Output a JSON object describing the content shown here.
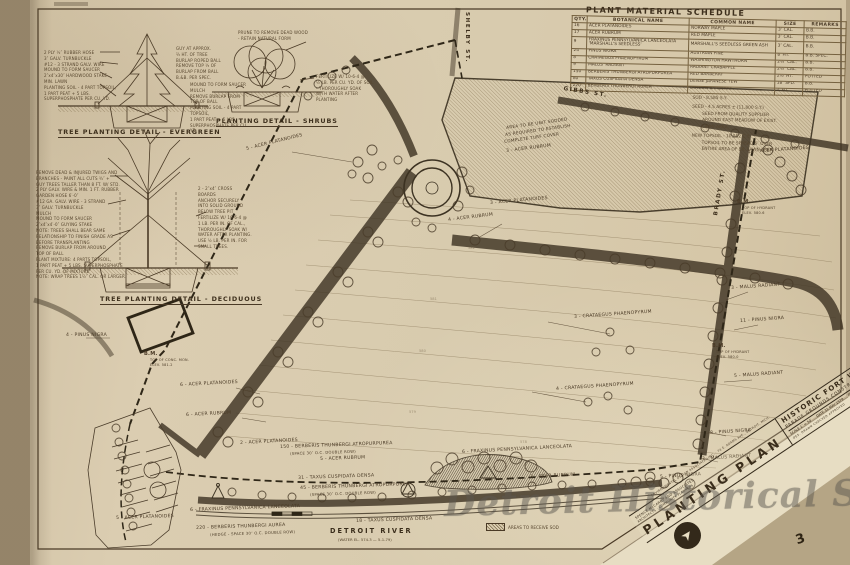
{
  "schedule": {
    "title": "PLANT MATERIAL SCHEDULE",
    "columns": [
      "QTY.",
      "BOTANICAL NAME",
      "COMMON NAME",
      "SIZE",
      "REMARKS"
    ],
    "rows": [
      [
        "16",
        "ACER PLATANOIDES",
        "NORWAY MAPLE",
        "3″ CAL.",
        "B.B."
      ],
      [
        "17",
        "ACER RUBRUM",
        "RED MAPLE",
        "3″ CAL.",
        "B.B."
      ],
      [
        "9",
        "FRAXINUS PENNSYLVANICA LANCEOLATA 'MARSHALL'S SEEDLESS'",
        "MARSHALL'S SEEDLESS GREEN ASH",
        "3″ CAL.",
        "B.B."
      ],
      [
        "24",
        "PINUS NIGRA",
        "AUSTRIAN PINE",
        "8′ HT.",
        "B.B. SPEC."
      ],
      [
        "8",
        "CRATAEGUS PHAENOPYRUM",
        "WASHINGTON HAWTHORN",
        "2½″ CAL.",
        "B.B."
      ],
      [
        "9",
        "MALUS 'RADIANT'",
        "RADIANT CRABAPPLE",
        "2½″ CAL.",
        "B.B."
      ],
      [
        "150",
        "BERBERIS THUNBERGI ATROPURPUREA",
        "RED BARBERRY",
        "2½′ HT.",
        "POTTED"
      ],
      [
        "80",
        "TAXUS CUSPIDATA DENSA",
        "DENSE JAPANESE YEW",
        "18″ SPD.",
        "B.B."
      ],
      [
        "220",
        "BERBERIS THUNBERGI AUREA",
        "GOLDEN BARBERRY",
        "2′ HT.",
        "POTTED"
      ]
    ]
  },
  "site_notes": [
    {
      "text": "SOD - 8,585 S.Y."
    },
    {
      "text": "SEED - 4.5 ACRES ± (11,800 S.Y.)",
      "gap": true
    },
    {
      "text": "SEED FROM QUALITY SUPPLIER",
      "indent": true
    },
    {
      "text": "AROUND EAST MEADOW OF EXIST.",
      "indent": true
    },
    {
      "text": "LAWN AREA.",
      "indent": true
    },
    {
      "text": "NEW TOPSOIL - 10,552 C.Y.",
      "gap": true
    },
    {
      "text": "TOPSOIL TO BE SPREAD 6″ OVER",
      "indent": true
    },
    {
      "text": "ENTIRE AREA OF EX. LAWN AREA.",
      "indent": true
    }
  ],
  "details": {
    "evergreen": {
      "title": "TREE PLANTING DETAIL - EVERGREEN",
      "left": [
        "2 PLY ½″ RUBBER HOSE",
        "3″ GALV. TURNBUCKLE",
        "#12 - 3 STRAND GALV. WIRE",
        "MOUND TO FORM SAUCER",
        "2″x4″x30″ HARDWOOD STAKE",
        "MIN. LAWN",
        "PLANTING SOIL - 4 PART TOPSOIL,",
        "1 PART PEAT + 5 LBS.",
        "SUPERPHOSPHATE PER CU. YD."
      ],
      "right": [
        "GUY AT APPROX.",
        "⅔ HT. OF TREE",
        "BURLAP ROPED BALL",
        "REMOVE TOP ⅓ OF",
        "BURLAP FROM BALL",
        "B.&B. PER SPEC."
      ]
    },
    "shrubs": {
      "title": "PLANTING DETAIL - SHRUBS",
      "top": [
        "PRUNE TO REMOVE DEAD WOOD",
        "- RETAIN NATURAL FORM"
      ],
      "left": [
        "MOUND TO FORM SAUCER",
        "MULCH",
        "REMOVE BURLAP FROM",
        "TOP OF BALL",
        "PLANTING SOIL - 4 PART TOPSOIL,",
        "1 PART PEAT + 5 LBS.",
        "SUPERPHOSPHATE PER CU. YD."
      ],
      "right": [
        "FERTILIZE W/ 10-6-4 @",
        "½ LB. PER CU. YD. OF SOIL",
        "- THOROUGHLY SOAK",
        "WITH WATER AFTER",
        "PLANTING"
      ]
    },
    "deciduous": {
      "title": "TREE PLANTING DETAIL - DECIDUOUS",
      "left": [
        "REMOVE DEAD & INJURED TWIGS AND",
        "BRANCHES - PAINT ALL CUTS ¾″ +",
        "GUY TREES TALLER THAN 8 FT. W/ STD.",
        "2 PLY GALV. WIRE & MIN. 1 FT. RUBBER",
        "GARDEN HOSE 6′-0″",
        "#12 GA. GALV. WIRE - 3 STRAND",
        "3″ GALV. TURNBUCKLE",
        "MULCH",
        "MOUND TO FORM SAUCER",
        "2″x4″x4′-0″ GUYING STAKE",
        "NOTE: TREES SHALL BEAR SAME",
        "RELATIONSHIP TO FINISH GRADE AS",
        "BEFORE TRANSPLANTING",
        "REMOVE BURLAP FROM AROUND",
        "TOP OF BALL",
        "PLANT MIXTURE: 4 PARTS TOPSOIL,",
        "1 PART PEAT + 5 LBS. SUPERPHOSPHATE",
        "PER CU. YD. OF MIXTURE",
        "NOTE: WRAP TREES 1½″ CAL. OR LARGER."
      ],
      "right": [
        "2 - 2″x4″ CROSS",
        "BOARDS",
        "ANCHOR SECURELY",
        "INTO SOLID GROUND",
        "BELOW TREE PIT",
        "FERTILIZE W/ 10-6-4 @",
        "1 LB. PER IN. OF CAL.,",
        "THOROUGHLY SOAK W/",
        "WATER AFTER PLANTING.",
        "USE ½ LB. PER IN. FOR",
        "SMALL TREES."
      ]
    }
  },
  "plan": {
    "streets": [
      {
        "text": "SHELBY ST.",
        "x": 470,
        "y": 12,
        "rot": 90
      },
      {
        "text": "GIBBS ST.",
        "x": 564,
        "y": 86,
        "rot": 9
      },
      {
        "text": "BRADY ST.",
        "x": 713,
        "y": 215,
        "rot": -80
      }
    ],
    "labels": [
      {
        "text": "5 - ACER PLATANOIDES",
        "x": 246,
        "y": 148,
        "rot": -14
      },
      {
        "text": "3 - ACER RUBRUM",
        "x": 506,
        "y": 150,
        "rot": -7
      },
      {
        "text": "3 - ACER PLATANOIDES",
        "x": 490,
        "y": 202,
        "rot": -5
      },
      {
        "text": "4 - ACER RUBRUM",
        "x": 448,
        "y": 219,
        "rot": -7
      },
      {
        "text": "12 - ACER PLATANOIDES",
        "x": 748,
        "y": 151,
        "rot": -4
      },
      {
        "text": "3 - CRATAEGUS PHAENOPYRUM",
        "x": 574,
        "y": 316,
        "rot": -4
      },
      {
        "text": "4 - CRATAEGUS PHAENOPYRUM",
        "x": 556,
        "y": 388,
        "rot": -4
      },
      {
        "text": "3 - MALUS RADIANT",
        "x": 731,
        "y": 287,
        "rot": -4
      },
      {
        "text": "11 - PINUS NIGRA",
        "x": 740,
        "y": 320,
        "rot": -4
      },
      {
        "text": "5 - MALUS RADIANT",
        "x": 734,
        "y": 375,
        "rot": -4
      },
      {
        "text": "8 - PINUS NIGRA",
        "x": 710,
        "y": 432,
        "rot": -4
      },
      {
        "text": "3 - MALUS RADIANT",
        "x": 702,
        "y": 458,
        "rot": -4
      },
      {
        "text": "5 - PINUS NIGRA",
        "x": 660,
        "y": 476,
        "rot": -4
      },
      {
        "text": "4 - PINUS NIGRA",
        "x": 66,
        "y": 334
      },
      {
        "text": "6 - ACER PLATANOIDES",
        "x": 180,
        "y": 384,
        "rot": -3
      },
      {
        "text": "6 - ACER RUBRUM",
        "x": 186,
        "y": 414,
        "rot": -3
      },
      {
        "text": "2 - ACER PLATANOIDES",
        "x": 240,
        "y": 442,
        "rot": -3
      },
      {
        "text": "150 - BERBERIS THUNBERGI ATROPURPUREA",
        "x": 280,
        "y": 446,
        "rot": -2
      },
      {
        "text": "(SPACE 30″ O.C. DOUBLE ROW)",
        "x": 290,
        "y": 452,
        "rot": -2,
        "size": 3.8
      },
      {
        "text": "5 - ACER RUBRUM",
        "x": 320,
        "y": 458,
        "rot": -2
      },
      {
        "text": "31 - TAXUS CUSPIDATA DENSA",
        "x": 298,
        "y": 477,
        "rot": -2
      },
      {
        "text": "45 - BERBERIS THUNBERGI ATROPURPUREA",
        "x": 300,
        "y": 487,
        "rot": -2
      },
      {
        "text": "(SPACE 30″ O.C. DOUBLE ROW)",
        "x": 310,
        "y": 493,
        "rot": -2,
        "size": 3.8
      },
      {
        "text": "2 - ACER RUBRUM",
        "x": 530,
        "y": 476,
        "rot": -3
      },
      {
        "text": "6 - FRAXINUS PENNSYLVANICA LANCEOLATA",
        "x": 462,
        "y": 451,
        "rot": -3
      },
      {
        "text": "18 - TAXUS CUSPIDATA DENSA",
        "x": 356,
        "y": 520,
        "rot": -2
      },
      {
        "text": "5 - ACER PLATANOIDES",
        "x": 116,
        "y": 517,
        "rot": -2
      },
      {
        "text": "6 - FRAXINUS PENNSYLVANICA LANCEOLATA",
        "x": 190,
        "y": 509,
        "rot": -2
      },
      {
        "text": "220 - BERBERIS THUNBERGI AUREA",
        "x": 196,
        "y": 527,
        "rot": -2
      },
      {
        "text": "(HEDGE - SPACE 30″ O.C. DOUBLE ROW)",
        "x": 210,
        "y": 533,
        "rot": -2,
        "size": 3.8
      },
      {
        "text": "AREA TO BE UNIT SODDED",
        "x": 506,
        "y": 126,
        "rot": -8,
        "size": 4.2
      },
      {
        "text": "AS REQUIRED TO ESTABLISH",
        "x": 505,
        "y": 133,
        "rot": -8,
        "size": 4.2
      },
      {
        "text": "COMPLETE TURF COVER",
        "x": 504,
        "y": 140,
        "rot": -8,
        "size": 4.2
      },
      {
        "text": "B.M.",
        "x": 144,
        "y": 352,
        "size": 5,
        "bold": true,
        "name": "benchmark-label"
      },
      {
        "text": "TOP OF CONC. MON.",
        "x": 150,
        "y": 359,
        "size": 3.4
      },
      {
        "text": "ELEV. 581.2",
        "x": 150,
        "y": 364,
        "size": 3.4
      },
      {
        "text": "B.M.",
        "x": 737,
        "y": 200,
        "size": 5,
        "bold": true,
        "name": "benchmark-label"
      },
      {
        "text": "TOP OF HYDRANT",
        "x": 742,
        "y": 207,
        "size": 3.4
      },
      {
        "text": "ELEV. 580.6",
        "x": 742,
        "y": 212,
        "size": 3.4
      },
      {
        "text": "B.M.",
        "x": 712,
        "y": 344,
        "size": 5,
        "bold": true,
        "name": "benchmark-label"
      },
      {
        "text": "TOP OF HYDRANT",
        "x": 716,
        "y": 351,
        "size": 3.4
      },
      {
        "text": "ELEV. 580.0",
        "x": 716,
        "y": 356,
        "size": 3.4
      }
    ],
    "contour_labels": [
      {
        "text": "582",
        "x": 468,
        "y": 246
      },
      {
        "text": "581",
        "x": 430,
        "y": 297
      },
      {
        "text": "580",
        "x": 419,
        "y": 349
      },
      {
        "text": "579",
        "x": 409,
        "y": 410
      },
      {
        "text": "578",
        "x": 520,
        "y": 440
      }
    ],
    "river": {
      "name": "DETROIT RIVER",
      "note": "(WATER EL. 574.3 — 5-1-79)"
    },
    "legend": {
      "label": "AREAS TO RECEIVE SOD"
    }
  },
  "title_block": {
    "stamp": "ENVIRONMENTAL DESIGN ASSOCIATES INC. · 74 E. ADAMS AVE., DETROIT, MICH.",
    "title": "PLANTING  PLAN",
    "firm_line1": "SPENCE McCARRY AND ASSOCIATES",
    "firm_line2": "ARCHITECTS · COMMUNITY PLANNERS",
    "project": "HISTORIC FORT WAYNE",
    "subproject": "PARADE GROUNDS CONSTRUCTION",
    "scale": "SCALE 1″ = 50′",
    "date": "DATE 31 MAY 1979",
    "approvals": "DES.   DRAWN   CHECKED   APPROVED",
    "project_no": "PROJ. NO. 76-10 H",
    "sheet_no": "3"
  },
  "watermark": "Detroit Historical Society"
}
